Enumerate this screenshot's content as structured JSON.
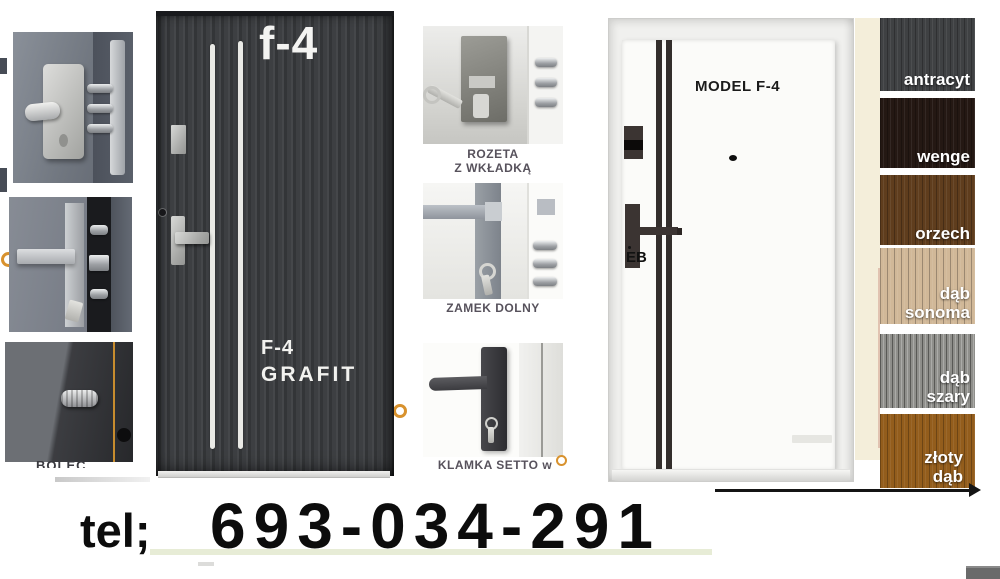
{
  "ad": {
    "phone_label": "tel;",
    "phone_number": "693-034-291"
  },
  "main_door": {
    "corner_label": "f-4",
    "model": "F-4",
    "finish": "GRAFIT"
  },
  "white_door": {
    "model_label": "MODEL F-4",
    "brand": "EB"
  },
  "captions": {
    "left_bottom_cutoff": "BOLEC",
    "rozeta_line1": "ROZETA",
    "rozeta_line2": "Z WKŁADKĄ",
    "zamek": "ZAMEK DOLNY",
    "klamka_cutoff": "KLAMKA SETTO w"
  },
  "swatches": [
    {
      "label": "antracyt",
      "color": "#3f4143"
    },
    {
      "label": "wenge",
      "color": "#241813"
    },
    {
      "label": "orzech",
      "color": "#5f3d1d"
    },
    {
      "label": "dąb sonoma",
      "color": "#d1b898"
    },
    {
      "label": "dąb szary",
      "color": "#8f8f8b"
    },
    {
      "label": "złoty dąb",
      "color": "#935d1c"
    }
  ],
  "colors": {
    "accent_orange": "#d8922e",
    "beige_strip": "#f4eeda",
    "stripe_inox": "#eaeae6",
    "stripe_dark": "#332e2c"
  }
}
